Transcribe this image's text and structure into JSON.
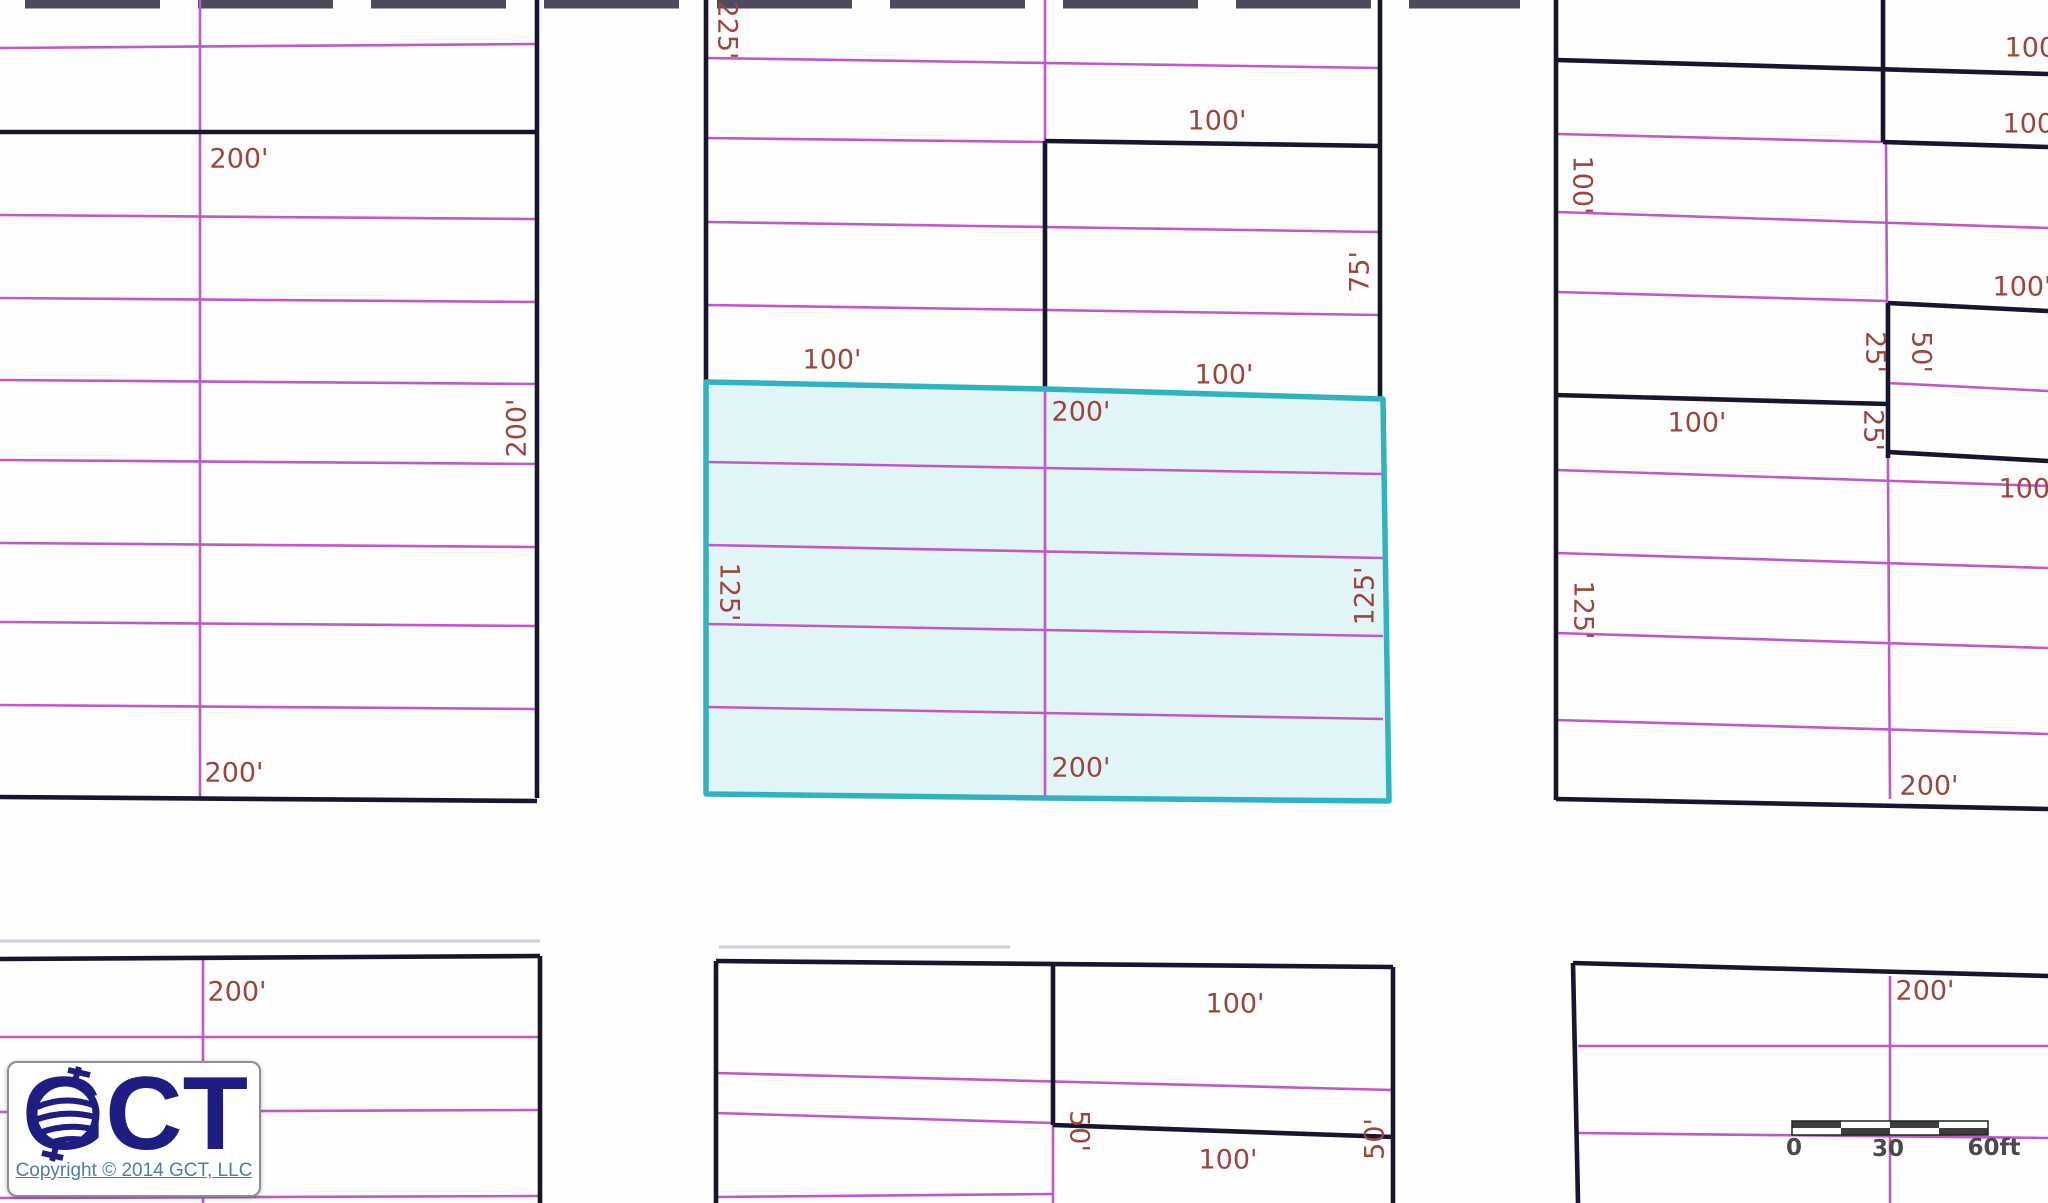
{
  "map": {
    "width": 2048,
    "height": 1203,
    "colors": {
      "background": "#fefefe",
      "boundary": "#16162e",
      "lot_line": "#c158c9",
      "highlight_fill": "#e1f4f8",
      "highlight_stroke": "#2fb3c1",
      "label": "#9d453c",
      "tick_bar": "#4b4b5c",
      "faint_line": "#a8a8bb",
      "scale_text": "#4a4a4a",
      "scale_dark": "#3d3d3d"
    },
    "label_font_size": 27,
    "boundary_lines": [
      [
        0,
        132,
        537,
        132
      ],
      [
        537,
        0,
        537,
        798
      ],
      [
        0,
        797,
        537,
        801
      ],
      [
        706,
        0,
        706,
        382
      ],
      [
        1380,
        0,
        1380,
        399
      ],
      [
        1045,
        141,
        1380,
        146
      ],
      [
        1045,
        141,
        1045,
        389
      ],
      [
        1556,
        0,
        1556,
        800
      ],
      [
        1556,
        60,
        2048,
        74
      ],
      [
        1883,
        0,
        1883,
        142
      ],
      [
        1883,
        142,
        2048,
        147
      ],
      [
        1555,
        395,
        1888,
        404
      ],
      [
        1888,
        303,
        2048,
        311
      ],
      [
        1888,
        303,
        1888,
        458
      ],
      [
        1888,
        452,
        2048,
        461
      ],
      [
        1556,
        799,
        2048,
        809
      ],
      [
        0,
        959,
        540,
        956
      ],
      [
        540,
        956,
        540,
        1203
      ],
      [
        716,
        961,
        1393,
        967
      ],
      [
        716,
        961,
        716,
        1203
      ],
      [
        1053,
        962,
        1053,
        1125
      ],
      [
        1393,
        967,
        1393,
        1203
      ],
      [
        1053,
        1125,
        1394,
        1137
      ],
      [
        1573,
        963,
        2048,
        976
      ],
      [
        1573,
        963,
        1578,
        1203
      ]
    ],
    "lot_lines": [
      [
        0,
        48,
        537,
        44
      ],
      [
        0,
        215,
        537,
        219
      ],
      [
        0,
        298,
        537,
        302
      ],
      [
        0,
        380,
        537,
        384
      ],
      [
        0,
        460,
        537,
        464
      ],
      [
        0,
        543,
        537,
        547
      ],
      [
        0,
        622,
        537,
        626
      ],
      [
        0,
        705,
        537,
        709
      ],
      [
        200,
        0,
        200,
        797
      ],
      [
        706,
        58,
        1380,
        68
      ],
      [
        706,
        138,
        1045,
        142
      ],
      [
        706,
        222,
        1380,
        232
      ],
      [
        706,
        305,
        1380,
        315
      ],
      [
        1045,
        0,
        1045,
        798
      ],
      [
        706,
        462,
        1383,
        474
      ],
      [
        706,
        545,
        1383,
        558
      ],
      [
        706,
        624,
        1383,
        636
      ],
      [
        706,
        707,
        1383,
        719
      ],
      [
        1556,
        134,
        1883,
        142
      ],
      [
        1556,
        212,
        2048,
        228
      ],
      [
        1556,
        292,
        1888,
        301
      ],
      [
        1888,
        383,
        2048,
        391
      ],
      [
        1556,
        470,
        2048,
        486
      ],
      [
        1556,
        553,
        2048,
        568
      ],
      [
        1556,
        633,
        2048,
        648
      ],
      [
        1556,
        720,
        2048,
        734
      ],
      [
        1886,
        142,
        1890,
        799
      ],
      [
        203,
        957,
        203,
        1203
      ],
      [
        0,
        1037,
        540,
        1037
      ],
      [
        0,
        1112,
        540,
        1110
      ],
      [
        0,
        1198,
        540,
        1196
      ],
      [
        716,
        1073,
        1393,
        1090
      ],
      [
        716,
        1113,
        1053,
        1123
      ],
      [
        1053,
        1125,
        1053,
        1203
      ],
      [
        716,
        1197,
        1053,
        1194
      ],
      [
        1890,
        976,
        1890,
        1203
      ],
      [
        1578,
        1046,
        2048,
        1046
      ],
      [
        1578,
        1133,
        2048,
        1138
      ]
    ],
    "top_tick_bar": {
      "x1": 25,
      "y": 4,
      "x2": 1520,
      "width": 9,
      "dash": "135 38"
    },
    "faint_lines": [
      [
        0,
        941,
        540,
        941
      ],
      [
        719,
        947,
        1010,
        947
      ]
    ],
    "highlight_parcel": {
      "points": "706,382 1045,389 1383,399 1389,801 1046,798 706,794",
      "stroke_width": 5.5
    },
    "dimension_labels": [
      {
        "t": "200'",
        "x": 239,
        "y": 159,
        "r": 0
      },
      {
        "t": "200'",
        "x": 517,
        "y": 428,
        "r": -90
      },
      {
        "t": "200'",
        "x": 234,
        "y": 773,
        "r": 0
      },
      {
        "t": "225'",
        "x": 727,
        "y": 30,
        "r": 90
      },
      {
        "t": "100'",
        "x": 1217,
        "y": 121,
        "r": 0
      },
      {
        "t": "75'",
        "x": 1360,
        "y": 272,
        "r": -90
      },
      {
        "t": "100'",
        "x": 832,
        "y": 360,
        "r": 0
      },
      {
        "t": "100'",
        "x": 1224,
        "y": 375,
        "r": 0
      },
      {
        "t": "200'",
        "x": 1081,
        "y": 412,
        "r": 0
      },
      {
        "t": "125'",
        "x": 729,
        "y": 592,
        "r": 90
      },
      {
        "t": "125'",
        "x": 1365,
        "y": 596,
        "r": -90
      },
      {
        "t": "200'",
        "x": 1081,
        "y": 768,
        "r": 0
      },
      {
        "t": "100'",
        "x": 2034,
        "y": 48,
        "r": 0
      },
      {
        "t": "100'",
        "x": 2032,
        "y": 124,
        "r": 0
      },
      {
        "t": "100'",
        "x": 1582,
        "y": 185,
        "r": 90
      },
      {
        "t": "100'",
        "x": 2022,
        "y": 287,
        "r": 0
      },
      {
        "t": "25'",
        "x": 1875,
        "y": 352,
        "r": 90
      },
      {
        "t": "50'",
        "x": 1921,
        "y": 352,
        "r": 90
      },
      {
        "t": "100'",
        "x": 1697,
        "y": 423,
        "r": 0
      },
      {
        "t": "25'",
        "x": 1873,
        "y": 430,
        "r": 90
      },
      {
        "t": "100'",
        "x": 2028,
        "y": 489,
        "r": 0
      },
      {
        "t": "125'",
        "x": 1583,
        "y": 610,
        "r": 90
      },
      {
        "t": "200'",
        "x": 1929,
        "y": 786,
        "r": 0
      },
      {
        "t": "200'",
        "x": 237,
        "y": 992,
        "r": 0
      },
      {
        "t": "100'",
        "x": 1235,
        "y": 1004,
        "r": 0
      },
      {
        "t": "50'",
        "x": 1079,
        "y": 1131,
        "r": 90
      },
      {
        "t": "50'",
        "x": 1375,
        "y": 1139,
        "r": -90
      },
      {
        "t": "100'",
        "x": 1228,
        "y": 1160,
        "r": 0
      },
      {
        "t": "200'",
        "x": 1925,
        "y": 991,
        "r": 0
      }
    ],
    "scale_bar": {
      "x": 1792,
      "y": 1121,
      "seg_w": 49,
      "row_h": 7,
      "segments": 4,
      "labels": [
        {
          "t": "0",
          "x": 1794,
          "y": 1148
        },
        {
          "t": "30",
          "x": 1888,
          "y": 1149
        },
        {
          "t": "60ft",
          "x": 1994,
          "y": 1148
        }
      ]
    }
  },
  "logo": {
    "title": "GCT",
    "copyright": "Copyright © 2014 GCT, LLC"
  }
}
